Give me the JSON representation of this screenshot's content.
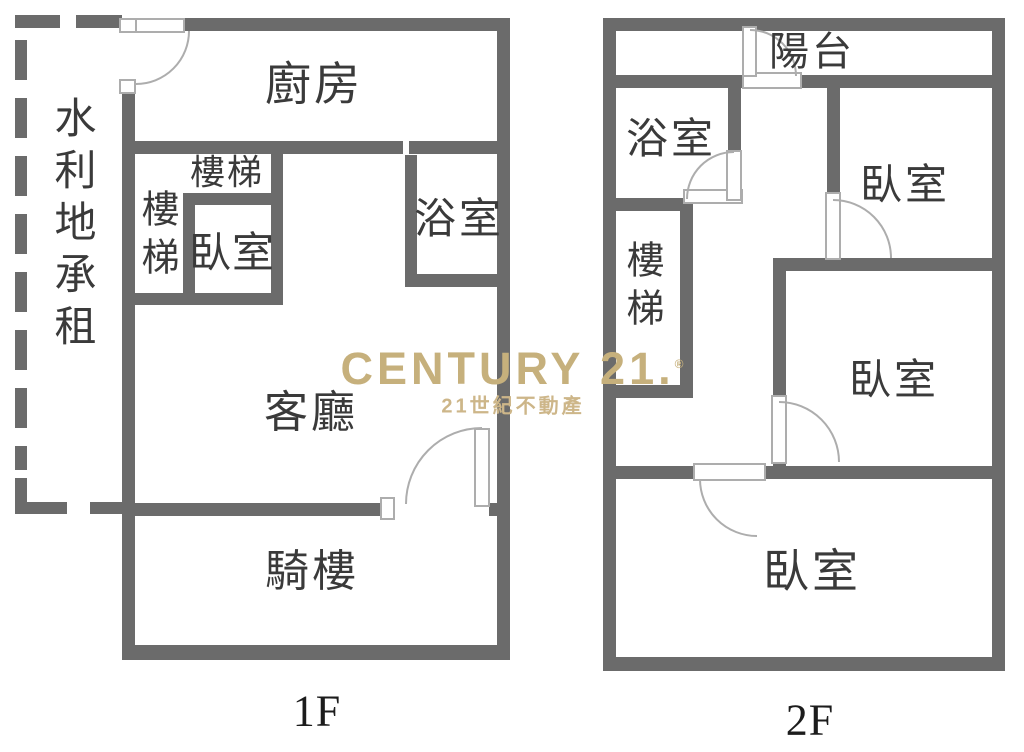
{
  "colors": {
    "wall": "#6B6B6B",
    "door_line": "#ADADAD",
    "room_label_text": "#3A3A3A",
    "floor_label_text": "#1C1C1C",
    "watermark_gold": "#C6B07C",
    "background": "#FFFFFF"
  },
  "watermark": {
    "brand": "CENTURY 21.",
    "registered": "®",
    "subtitle": "21世紀不動產"
  },
  "floor1": {
    "label": "1F",
    "side_annotation": "水利地承租",
    "rooms": {
      "kitchen": "廚房",
      "stairs_top": "樓梯",
      "stairs_side": "樓梯",
      "bedroom": "臥室",
      "bathroom": "浴室",
      "living_room": "客廳",
      "arcade": "騎樓"
    }
  },
  "floor2": {
    "label": "2F",
    "rooms": {
      "balcony": "陽台",
      "bathroom": "浴室",
      "stairs": "樓梯",
      "bedroom_top": "臥室",
      "bedroom_middle": "臥室",
      "bedroom_bottom": "臥室"
    }
  }
}
